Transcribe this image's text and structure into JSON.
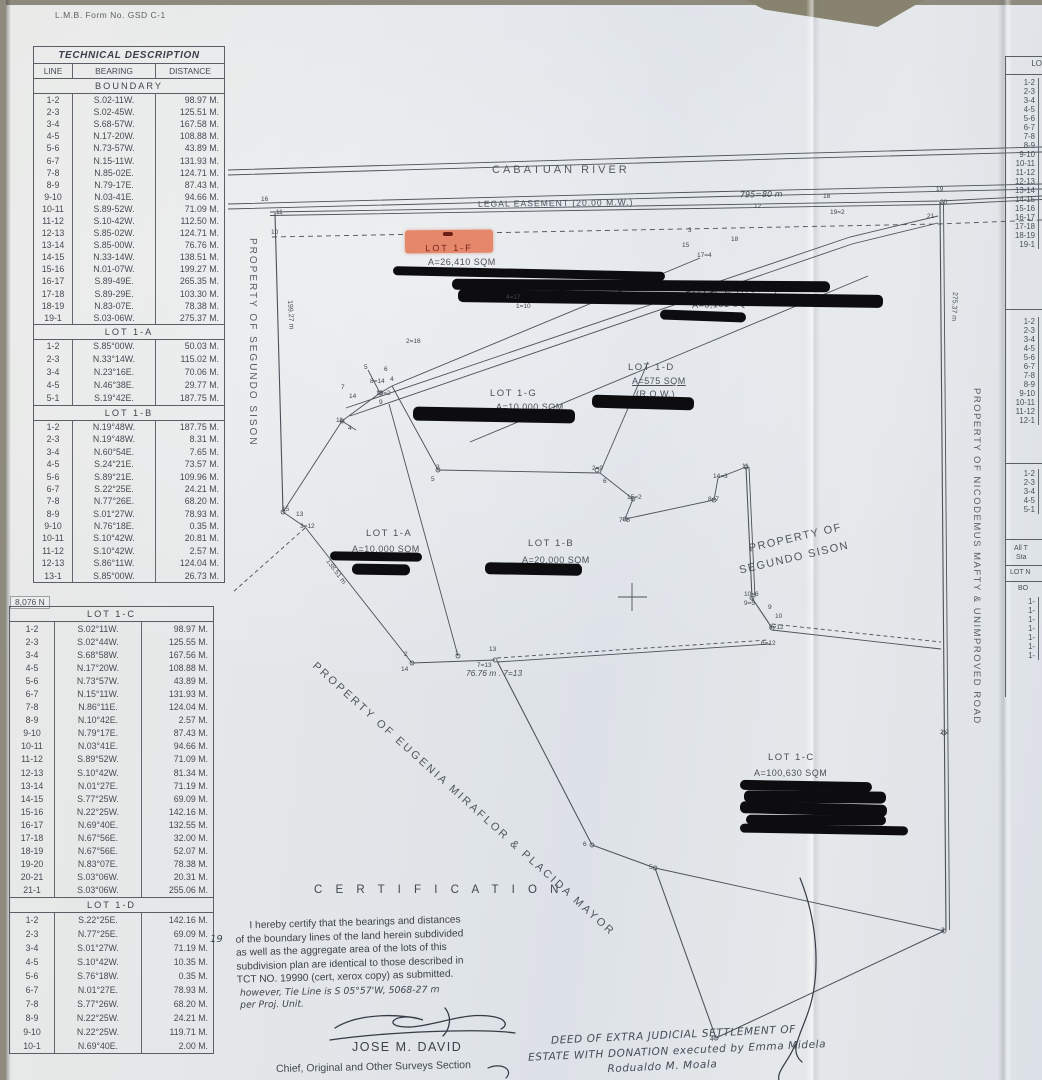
{
  "form_label": "L.M.B. Form No. GSD C-1",
  "grid_label": "8,076 N",
  "technical_description": {
    "title": "TECHNICAL DESCRIPTION",
    "columns": [
      "LINE",
      "BEARING",
      "DISTANCE"
    ],
    "sections": [
      {
        "name": "BOUNDARY",
        "rows": [
          [
            "1-2",
            "S.02-11W.",
            "98.97 M."
          ],
          [
            "2-3",
            "S.02-45W.",
            "125.51 M."
          ],
          [
            "3-4",
            "S.68-57W.",
            "167.58 M."
          ],
          [
            "4-5",
            "N.17-20W.",
            "108.88 M."
          ],
          [
            "5-6",
            "N.73-57W.",
            "43.89 M."
          ],
          [
            "6-7",
            "N.15-11W.",
            "131.93 M."
          ],
          [
            "7-8",
            "N.85-02E.",
            "124.71 M."
          ],
          [
            "8-9",
            "N.79-17E.",
            "87.43 M."
          ],
          [
            "9-10",
            "N.03-41E.",
            "94.66 M."
          ],
          [
            "10-11",
            "S.89-52W.",
            "71.09 M."
          ],
          [
            "11-12",
            "S.10-42W.",
            "112.50 M."
          ],
          [
            "12-13",
            "S.85-02W.",
            "124.71 M."
          ],
          [
            "13-14",
            "S.85-00W.",
            "76.76 M."
          ],
          [
            "14-15",
            "N.33-14W.",
            "138.51 M."
          ],
          [
            "15-16",
            "N.01-07W.",
            "199.27 M."
          ],
          [
            "16-17",
            "S.89-49E.",
            "265.35 M."
          ],
          [
            "17-18",
            "S.89-29E.",
            "103.30 M."
          ],
          [
            "18-19",
            "N.83-07E.",
            "78.38 M."
          ],
          [
            "19-1",
            "S.03-06W.",
            "275.37 M."
          ]
        ]
      },
      {
        "name": "LOT  1-A",
        "rows": [
          [
            "1-2",
            "S.85°00W.",
            "50.03 M."
          ],
          [
            "2-3",
            "N.33°14W.",
            "115.02 M."
          ],
          [
            "3-4",
            "N.23°16E.",
            "70.06 M."
          ],
          [
            "4-5",
            "N.46°38E.",
            "29.77 M."
          ],
          [
            "5-1",
            "S.19°42E.",
            "187.75 M."
          ]
        ]
      },
      {
        "name": "LOT  1-B",
        "rows": [
          [
            "1-2",
            "N.19°48W.",
            "187.75 M."
          ],
          [
            "2-3",
            "N.19°48W.",
            "8.31 M."
          ],
          [
            "3-4",
            "N.60°54E.",
            "7.65 M."
          ],
          [
            "4-5",
            "S.24°21E.",
            "73.57 M."
          ],
          [
            "5-6",
            "S.89°21E.",
            "109.96 M."
          ],
          [
            "6-7",
            "S.22°25E.",
            "24.21 M."
          ],
          [
            "7-8",
            "N.77°26E.",
            "68.20 M."
          ],
          [
            "8-9",
            "S.01°27W.",
            "78.93 M."
          ],
          [
            "9-10",
            "N.76°18E.",
            "0.35 M."
          ],
          [
            "10-11",
            "S.10°42W.",
            "20.81 M."
          ],
          [
            "11-12",
            "S.10°42W.",
            "2.57 M."
          ],
          [
            "12-13",
            "S.86°11W.",
            "124.04 M."
          ],
          [
            "13-1",
            "S.85°00W.",
            "26.73 M."
          ]
        ]
      },
      {
        "name": "LOT  1-C",
        "rows": [
          [
            "1-2",
            "S.02°11W.",
            "98.97 M."
          ],
          [
            "2-3",
            "S.02°44W.",
            "125.55 M."
          ],
          [
            "3-4",
            "S.68°58W.",
            "167.56 M."
          ],
          [
            "4-5",
            "N.17°20W.",
            "108.88 M."
          ],
          [
            "5-6",
            "N.73°57W.",
            "43.89 M."
          ],
          [
            "6-7",
            "N.15°11W.",
            "131.93 M."
          ],
          [
            "7-8",
            "N.86°11E.",
            "124.04 M."
          ],
          [
            "8-9",
            "N.10°42E.",
            "2.57 M."
          ],
          [
            "9-10",
            "N.79°17E.",
            "87.43 M."
          ],
          [
            "10-11",
            "N.03°41E.",
            "94.66 M."
          ],
          [
            "11-12",
            "S.89°52W.",
            "71.09 M."
          ],
          [
            "12-13",
            "S.10°42W.",
            "81.34 M."
          ],
          [
            "13-14",
            "N.01°27E.",
            "71.19 M."
          ],
          [
            "14-15",
            "S.77°25W.",
            "69.09 M."
          ],
          [
            "15-16",
            "N.22°25W.",
            "142.16 M."
          ],
          [
            "16-17",
            "N.69°40E.",
            "132.55 M."
          ],
          [
            "17-18",
            "N.67°56E.",
            "32.00 M."
          ],
          [
            "18-19",
            "N.67°56E.",
            "52.07 M."
          ],
          [
            "19-20",
            "N.83°07E.",
            "78.38 M."
          ],
          [
            "20-21",
            "S.03°06W.",
            "20.31 M."
          ],
          [
            "21-1",
            "S.03°06W.",
            "255.06 M."
          ]
        ]
      },
      {
        "name": "LOT  1-D",
        "rows": [
          [
            "1-2",
            "S.22°25E.",
            "142.16 M."
          ],
          [
            "2-3",
            "N.77°25E.",
            "69.09 M."
          ],
          [
            "3-4",
            "S.01°27W.",
            "71.19 M."
          ],
          [
            "4-5",
            "S.10°42W.",
            "10.35 M."
          ],
          [
            "5-6",
            "S.76°18W.",
            "0.35 M."
          ],
          [
            "6-7",
            "N.01°27E.",
            "78.93 M."
          ],
          [
            "7-8",
            "S.77°26W.",
            "68.20 M."
          ],
          [
            "8-9",
            "N.22°25W.",
            "24.21 M."
          ],
          [
            "9-10",
            "N.22°25W.",
            "119.71 M."
          ],
          [
            "10-1",
            "N.69°40E.",
            "2.00 M."
          ]
        ]
      }
    ]
  },
  "map": {
    "river_label": "CABATUAN RIVER",
    "easement_label": "LEGAL EASEMENT (20.00 M.W.)",
    "lots": [
      {
        "name": "LOT 1-F",
        "area": "A=26,410 SQM"
      },
      {
        "name": "LOT 1-E (ROAD)",
        "area": "A=3,161 SQM"
      },
      {
        "name": "LOT 1-G",
        "area": "A=10,000 SQM."
      },
      {
        "name": "LOT 1-D",
        "area": "A=575 SQM",
        "note": "(R.O.W.)"
      },
      {
        "name": "LOT 1-A",
        "area": "A=10,000 SQM"
      },
      {
        "name": "LOT 1-B",
        "area": "A=20,000 SQM"
      },
      {
        "name": "LOT 1-C",
        "area": "A=100,630 SQM"
      }
    ],
    "adjacent_properties": {
      "west": "PROPERTY  OF  SEGUNDO  SISON",
      "east": "PROPERTY  OF  NICODEMUS  MAFTY  &  UNIMPROVED  ROAD",
      "southwest": "PROPERTY OF EUGENIA MIRAFLOR & PLACIDA MAYOR",
      "center_line1": "PROPERTY OF",
      "center_line2": "SEGUNDO SISON"
    },
    "measurements": {
      "bottom": "76.76 m .  7=13",
      "west_upper": "199.27 m",
      "west_lower": "138.51 m",
      "east": "275.37 m",
      "top_handwritten": "795=80 m"
    },
    "handwritten_mark": "19",
    "vertex_labels": [
      {
        "t": "16",
        "x": 261,
        "y": 196
      },
      {
        "t": "11",
        "x": 276,
        "y": 209
      },
      {
        "t": "10",
        "x": 271,
        "y": 229
      },
      {
        "t": "12",
        "x": 754,
        "y": 203
      },
      {
        "t": "18",
        "x": 823,
        "y": 193
      },
      {
        "t": "19=2",
        "x": 830,
        "y": 209
      },
      {
        "t": "19",
        "x": 936,
        "y": 186
      },
      {
        "t": "20",
        "x": 940,
        "y": 199
      },
      {
        "t": "21",
        "x": 927,
        "y": 213
      },
      {
        "t": "3",
        "x": 688,
        "y": 227
      },
      {
        "t": "15",
        "x": 682,
        "y": 242
      },
      {
        "t": "18",
        "x": 731,
        "y": 236
      },
      {
        "t": "17=4",
        "x": 697,
        "y": 252
      },
      {
        "t": "4=17",
        "x": 506,
        "y": 294
      },
      {
        "t": "1=10",
        "x": 516,
        "y": 303
      },
      {
        "t": "2=16",
        "x": 406,
        "y": 338
      },
      {
        "t": "5",
        "x": 364,
        "y": 364
      },
      {
        "t": "6",
        "x": 384,
        "y": 366
      },
      {
        "t": "8=14",
        "x": 370,
        "y": 378
      },
      {
        "t": "4",
        "x": 390,
        "y": 376
      },
      {
        "t": "7",
        "x": 341,
        "y": 384
      },
      {
        "t": "14",
        "x": 349,
        "y": 393
      },
      {
        "t": "10=2",
        "x": 376,
        "y": 390
      },
      {
        "t": "9",
        "x": 379,
        "y": 399
      },
      {
        "t": "11",
        "x": 336,
        "y": 417
      },
      {
        "t": "4",
        "x": 348,
        "y": 425
      },
      {
        "t": "3",
        "x": 436,
        "y": 464
      },
      {
        "t": "5",
        "x": 431,
        "y": 476
      },
      {
        "t": "2=9",
        "x": 592,
        "y": 465
      },
      {
        "t": "6",
        "x": 603,
        "y": 478
      },
      {
        "t": "15=2",
        "x": 627,
        "y": 494
      },
      {
        "t": "7=8",
        "x": 619,
        "y": 517
      },
      {
        "t": "14=3",
        "x": 713,
        "y": 473
      },
      {
        "t": "8=7",
        "x": 708,
        "y": 496
      },
      {
        "t": "11",
        "x": 742,
        "y": 463
      },
      {
        "t": "15",
        "x": 282,
        "y": 506
      },
      {
        "t": "13",
        "x": 296,
        "y": 511
      },
      {
        "t": "3=12",
        "x": 300,
        "y": 523
      },
      {
        "t": "2",
        "x": 404,
        "y": 651
      },
      {
        "t": "14",
        "x": 401,
        "y": 666
      },
      {
        "t": "1",
        "x": 455,
        "y": 650
      },
      {
        "t": "13",
        "x": 489,
        "y": 646
      },
      {
        "t": "7=13",
        "x": 477,
        "y": 662
      },
      {
        "t": "10=6",
        "x": 744,
        "y": 591
      },
      {
        "t": "9=5",
        "x": 744,
        "y": 600
      },
      {
        "t": "8=12",
        "x": 769,
        "y": 624
      },
      {
        "t": "6=12",
        "x": 761,
        "y": 640
      },
      {
        "t": "9",
        "x": 768,
        "y": 604
      },
      {
        "t": "10",
        "x": 775,
        "y": 613
      },
      {
        "t": "2|2",
        "x": 940,
        "y": 729
      },
      {
        "t": "6",
        "x": 583,
        "y": 841
      },
      {
        "t": "5",
        "x": 649,
        "y": 864
      },
      {
        "t": "3",
        "x": 941,
        "y": 927
      },
      {
        "t": "4",
        "x": 710,
        "y": 1036
      }
    ]
  },
  "certification": {
    "title": "C E R T I F I C A T I O N",
    "body_lines": [
      "     I hereby certify that the bearings and distances",
      "of the boundary lines of the land herein subdivided",
      "as well as the aggregate area of the lots of this",
      "subdivision plan are identical to those described in",
      "TCT NO. 19990 (cert, xerox copy) as submitted."
    ],
    "note_lines": [
      "however, Tie Line is S 05°57'W, 5068-27 m",
      "per Proj. Unit."
    ],
    "signatory": "JOSE M. DAVID",
    "signatory_title": "Chief, Original and Other Surveys Section"
  },
  "deed_note_lines": [
    "      DEED OF EXTRA JUDICIAL SETTLEMENT OF",
    "ESTATE WITH DONATION executed by Emma Midela",
    "                    Rodualdo M. Moala"
  ],
  "right_table": {
    "header": "LO",
    "section1_rows": [
      "1-2",
      "2-3",
      "3-4",
      "4-5",
      "5-6",
      "6-7",
      "7-8",
      "8-9",
      "9-10",
      "10-11",
      "11-12",
      "12-13",
      "13-14",
      "14-15",
      "15-16",
      "16-17",
      "17-18",
      "18-19",
      "19-1"
    ],
    "section2_rows": [
      "1-2",
      "2-3",
      "3-4",
      "4-5",
      "5-6",
      "6-7",
      "7-8",
      "8-9",
      "9-10",
      "10-11",
      "11-12",
      "12-1"
    ],
    "section3_rows": [
      "1-2",
      "2-3",
      "3-4",
      "4-5",
      "5-1"
    ],
    "footer_label1": "All T",
    "footer_label2": "Sta",
    "footer_label3": "LOT N",
    "footer_label4": "BO",
    "footer_rows": [
      "1-",
      "1-",
      "1-",
      "1-",
      "1-",
      "1-",
      "1-"
    ]
  },
  "colors": {
    "paper": "#e4e7e9",
    "ink": "#42474f",
    "redaction": "#0d0d0f",
    "highlight": "#e5876b"
  }
}
